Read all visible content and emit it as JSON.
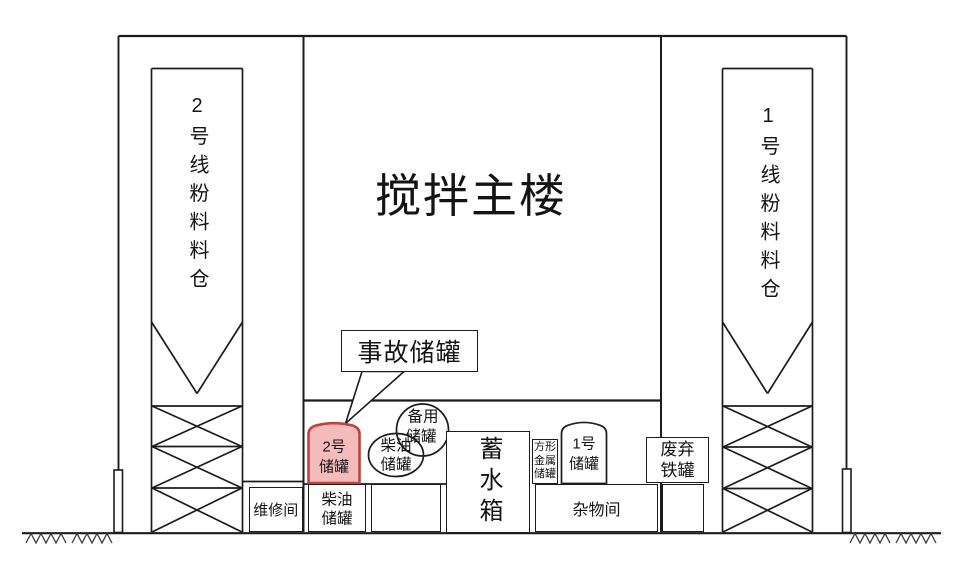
{
  "colors": {
    "line": "#1c1c1c",
    "highlight_fill": "#f3bcba",
    "highlight_stroke": "#c2413c"
  },
  "main_building": {
    "label": "搅拌主楼"
  },
  "silo_left": {
    "label": "2号线粉料料仓"
  },
  "silo_right": {
    "label": "1号线粉料料仓"
  },
  "callout": {
    "label": "事故储罐"
  },
  "tank_accident": {
    "line1": "2号",
    "line2": "储罐"
  },
  "tank_backup": {
    "line1": "备用",
    "line2": "储罐"
  },
  "tank_diesel_upper": {
    "line1": "柴油",
    "line2": "储罐"
  },
  "tank_diesel_lower": {
    "line1": "柴油",
    "line2": "储罐"
  },
  "tank_no1": {
    "line1": "1号",
    "line2": "储罐"
  },
  "tank_square_metal": {
    "line1": "方形",
    "line2": "金属",
    "line3": "储罐"
  },
  "tank_scrap_iron": {
    "line1": "废弃",
    "line2": "铁罐"
  },
  "room_maintenance": {
    "label": "维修间"
  },
  "room_sundry": {
    "label": "杂物间"
  },
  "water_tank": {
    "label": "蓄水箱"
  }
}
